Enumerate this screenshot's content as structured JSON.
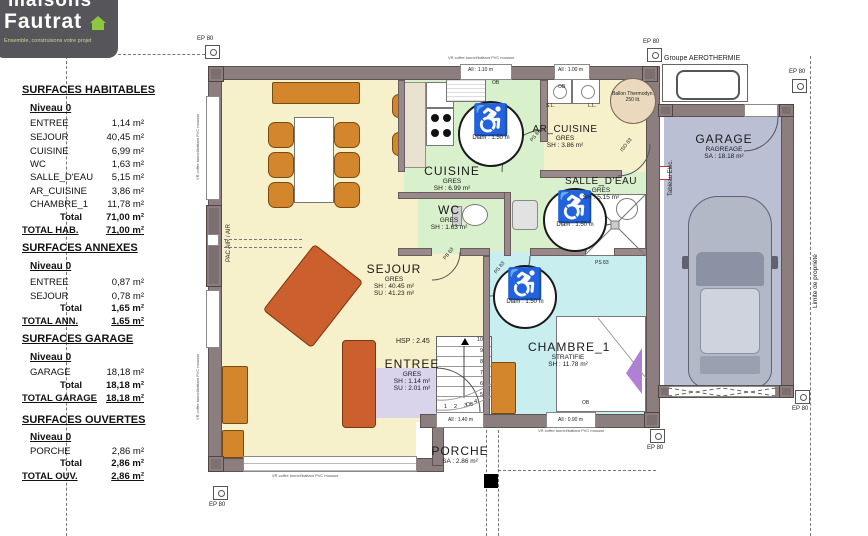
{
  "brand": {
    "name_top": "maisons",
    "name_bottom": "Fautrat",
    "tagline": "Ensemble, construisons votre projet",
    "accent_color": "#8dc63f",
    "bg_color": "#56565a"
  },
  "panel": {
    "sections": [
      {
        "title": "SURFACES HABITABLES",
        "level": "Niveau 0",
        "rows": [
          {
            "n": "ENTREE",
            "v": "1,14 m²"
          },
          {
            "n": "SEJOUR",
            "v": "40,45 m²"
          },
          {
            "n": "CUISINE",
            "v": "6,99 m²"
          },
          {
            "n": "WC",
            "v": "1,63 m²"
          },
          {
            "n": "SALLE_D'EAU",
            "v": "5,15 m²"
          },
          {
            "n": "AR_CUISINE",
            "v": "3,86 m²"
          },
          {
            "n": "CHAMBRE_1",
            "v": "11,78 m²"
          }
        ],
        "total_label": "Total",
        "total": "71,00 m²",
        "grand_label": "TOTAL HAB.",
        "grand": "71,00 m²"
      },
      {
        "title": "SURFACES ANNEXES",
        "level": "Niveau 0",
        "rows": [
          {
            "n": "ENTREE",
            "v": "0,87 m²"
          },
          {
            "n": "SEJOUR",
            "v": "0,78 m²"
          }
        ],
        "total_label": "Total",
        "total": "1,65 m²",
        "grand_label": "TOTAL ANN.",
        "grand": "1,65 m²"
      },
      {
        "title": "SURFACES GARAGE",
        "level": "Niveau 0",
        "rows": [
          {
            "n": "GARAGE",
            "v": "18,18 m²"
          }
        ],
        "total_label": "Total",
        "total": "18,18 m²",
        "grand_label": "TOTAL GARAGE",
        "grand": "18,18 m²"
      },
      {
        "title": "SURFACES OUVERTES",
        "level": "Niveau 0",
        "rows": [
          {
            "n": "PORCHE",
            "v": "2,86 m²"
          }
        ],
        "total_label": "Total",
        "total": "2,86 m²",
        "grand_label": "TOTAL OUV.",
        "grand": "2,86 m²"
      }
    ]
  },
  "rooms": {
    "cuisine": {
      "name": "CUISINE",
      "mat": "GRES",
      "a1": "SH : 6.99 m²"
    },
    "ar_cuisine": {
      "name": "AR_CUISINE",
      "mat": "GRES",
      "a1": "SH : 3.86 m²"
    },
    "salle_deau": {
      "name": "SALLE_D'EAU",
      "mat": "GRES",
      "a1": "SH : 5.15 m²"
    },
    "wc": {
      "name": "WC",
      "mat": "GRES",
      "a1": "SH : 1.63 m²"
    },
    "sejour": {
      "name": "SEJOUR",
      "mat": "GRES",
      "a1": "SH : 40.45 m²",
      "a2": "SU : 41.23 m²"
    },
    "entree": {
      "name": "ENTREE",
      "mat": "GRES",
      "a1": "SH : 1.14 m²",
      "a2": "SU : 2.01 m²"
    },
    "chambre": {
      "name": "CHAMBRE_1",
      "mat": "STRATIFIE",
      "a1": "SH : 11.78 m²"
    },
    "garage": {
      "name": "GARAGE",
      "mat": "RAGREAGE",
      "a1": "SA : 18.18 m²"
    },
    "porche": {
      "name": "PORCHE",
      "a1": "SA : 2.86 m²"
    }
  },
  "annotations": {
    "groupe_aerothermie": "Groupe AEROTHERMIE",
    "ballon_l1": "Ballon Thermodyn.",
    "ballon_l2": "250 lit.",
    "diam": "Diam : 1.50 m",
    "hsp": "HSP : 2.45",
    "pac": "PAC AIR / AIR",
    "tableau_elec": "Tableau Elec.",
    "limite": "Limite de propriété",
    "ep80": "EP 80",
    "ps83": "PS 83",
    "iso83": "ISO 83",
    "pb63": "PB 63",
    "ob": "OB",
    "sl": "S.L.",
    "ll": "L.L.",
    "win_110": "All : 1.10 m",
    "win_100": "All : 1.00 m",
    "win_140": "All : 1.40 m",
    "win_090": "All : 0.90 m",
    "vr_note": "VR coffre tunnel/battant PVC mousse",
    "shower_d1": "1.20",
    "shower_d2": "0.80",
    "stair_numbers": [
      "1",
      "2",
      "3",
      "4",
      "5",
      "6",
      "7",
      "8",
      "9",
      "10"
    ]
  },
  "colors": {
    "wall": "#8c7e7e",
    "sejour_floor": "#f6f1ca",
    "wet_floor": "#d9f0cc",
    "entree_floor": "#d9d3ec",
    "chambre_floor": "#c8eef0",
    "garage_floor": "#babfd4",
    "furniture": "#d3862c",
    "sofa": "#cc5f2e"
  }
}
